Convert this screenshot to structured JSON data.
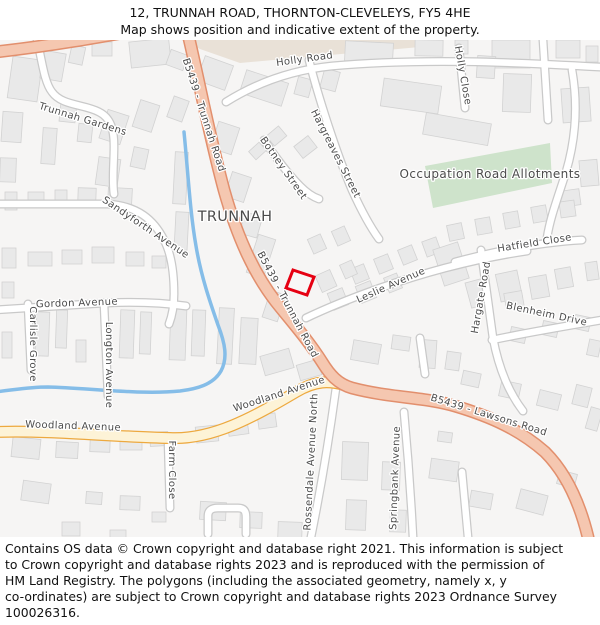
{
  "header": {
    "title": "12, TRUNNAH ROAD, THORNTON-CLEVELEYS, FY5 4HE",
    "subtitle": "Map shows position and indicative extent of the property."
  },
  "map": {
    "place_label": "TRUNNAH",
    "property_outline_color": "#e60012",
    "colors": {
      "b_road_fill": "#f5c7b0",
      "b_road_casing": "#e28f6d",
      "minor_through_road_fill": "#fdf3d7",
      "minor_through_road_casing": "#eda93f",
      "water": "#85bde8",
      "allotments_green": "#cee3cb",
      "landuse_beige": "#e9e1d7",
      "building": "#e9e9e9",
      "background": "#f6f5f4"
    },
    "labels": [
      {
        "text": "Holly Road",
        "x": 305,
        "y": 22,
        "rot": -8,
        "size": 10
      },
      {
        "text": "Holly Close",
        "x": 460,
        "y": 36,
        "rot": 80,
        "size": 10
      },
      {
        "text": "Hargreaves Street",
        "x": 333,
        "y": 115,
        "rot": 63,
        "size": 10
      },
      {
        "text": "Botney Street",
        "x": 281,
        "y": 130,
        "rot": 55,
        "size": 10
      },
      {
        "text": "B5439 - Trunnah Road",
        "x": 201,
        "y": 76,
        "rot": 72,
        "size": 10
      },
      {
        "text": "B5439 - Trunnah Road",
        "x": 285,
        "y": 266,
        "rot": 62,
        "size": 10
      },
      {
        "text": "TRUNNAH",
        "x": 235,
        "y": 181,
        "rot": 0,
        "size": 14.5,
        "color": "#1a1a1a",
        "spacing": "1.2"
      },
      {
        "text": "Occupation Road Allotments",
        "x": 490,
        "y": 138,
        "rot": 0,
        "size": 12,
        "color": "#3d3d3d"
      },
      {
        "text": "Hatfield Close",
        "x": 535,
        "y": 206,
        "rot": -9,
        "size": 10
      },
      {
        "text": "Leslie Avenue",
        "x": 392,
        "y": 248,
        "rot": -24,
        "size": 10
      },
      {
        "text": "Hargate Road",
        "x": 484,
        "y": 258,
        "rot": -80,
        "size": 10
      },
      {
        "text": "Blenheim Drive",
        "x": 546,
        "y": 277,
        "rot": 12,
        "size": 10
      },
      {
        "text": "B5439 - Lawsons Road",
        "x": 488,
        "y": 378,
        "rot": 17,
        "size": 10
      },
      {
        "text": "Woodland Avenue",
        "x": 73,
        "y": 389,
        "rot": 2,
        "size": 10
      },
      {
        "text": "Woodland Avenue",
        "x": 280,
        "y": 357,
        "rot": -18,
        "size": 10
      },
      {
        "text": "Gordon Avenue",
        "x": 77,
        "y": 266,
        "rot": -2,
        "size": 10
      },
      {
        "text": "Carlisle Grove",
        "x": 30,
        "y": 304,
        "rot": 90,
        "size": 10
      },
      {
        "text": "Longton Avenue",
        "x": 106,
        "y": 325,
        "rot": 90,
        "size": 10
      },
      {
        "text": "Farm Close",
        "x": 169,
        "y": 430,
        "rot": 90,
        "size": 10
      },
      {
        "text": "Rossendale Avenue North",
        "x": 314,
        "y": 422,
        "rot": -87,
        "size": 10
      },
      {
        "text": "Springbank Avenue",
        "x": 398,
        "y": 438,
        "rot": -88,
        "size": 10
      },
      {
        "text": "Sandyforth Avenue",
        "x": 144,
        "y": 190,
        "rot": 34,
        "size": 10
      },
      {
        "text": "Trunnah Gardens",
        "x": 82,
        "y": 82,
        "rot": 17,
        "size": 10
      }
    ]
  },
  "footer": {
    "copyright_lines": [
      "Contains OS data © Crown copyright and database right 2021. This information is subject",
      "to Crown copyright and database rights 2023 and is reproduced with the permission of",
      "HM Land Registry. The polygons (including the associated geometry, namely x, y",
      "co-ordinates) are subject to Crown copyright and database rights 2023 Ordnance Survey",
      "100026316."
    ]
  }
}
